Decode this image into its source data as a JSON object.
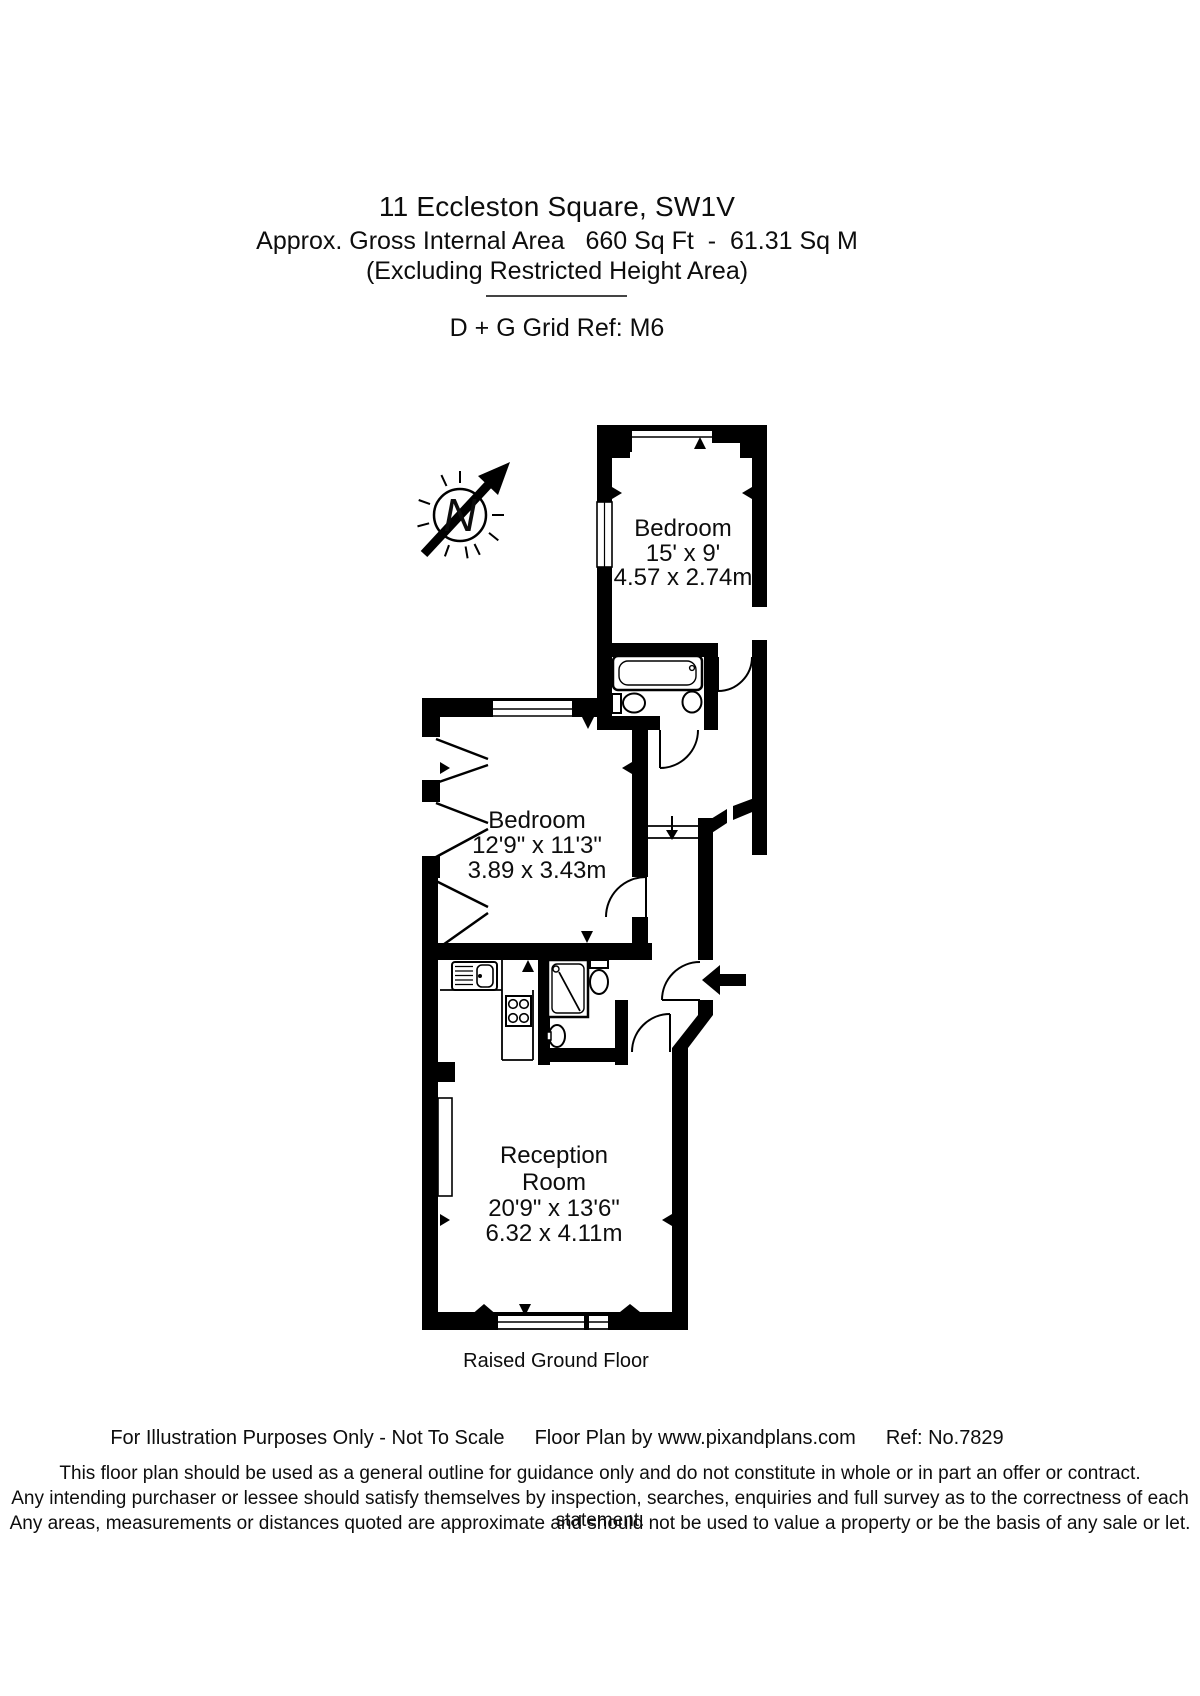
{
  "page": {
    "background": "#ffffff",
    "ink": "#000000"
  },
  "header": {
    "address": "11 Eccleston Square, SW1V",
    "area_line": "Approx. Gross Internal Area   660 Sq Ft  -  61.31 Sq M",
    "exclusion_note": "(Excluding Restricted Height Area)",
    "grid_ref": "D + G Grid Ref: M6"
  },
  "floorplan": {
    "floor_label": "Raised Ground Floor",
    "compass": {
      "label": "N"
    },
    "rooms": [
      {
        "name": "Bedroom",
        "dimensions_imperial": "15' x 9'",
        "dimensions_metric": "4.57 x 2.74m"
      },
      {
        "name": "Bedroom",
        "dimensions_imperial": "12'9\" x 11'3\"",
        "dimensions_metric": "3.89 x 3.43m"
      },
      {
        "name_line1": "Reception",
        "name_line2": "Room",
        "dimensions_imperial": "20'9\" x 13'6\"",
        "dimensions_metric": "6.32 x 4.11m"
      }
    ],
    "fixtures": [
      "bathtub",
      "toilet",
      "wash-basin",
      "shower",
      "toilet",
      "wash-basin",
      "kitchen-sink",
      "hob"
    ]
  },
  "footer": {
    "illustration_note": "For Illustration Purposes Only - Not To Scale",
    "credit": "Floor Plan by www.pixandplans.com",
    "reference": "Ref: No.7829",
    "disclaimer_line1": "This floor plan should be used as a general outline for guidance only and do not constitute in whole or in part an offer or contract.",
    "disclaimer_line2": "Any intending purchaser or lessee should satisfy themselves by inspection, searches, enquiries and full survey as to the correctness of each statement.",
    "disclaimer_line3": "Any areas, measurements or distances quoted are approximate and should not be used to value a property or be the basis of any sale or let."
  }
}
